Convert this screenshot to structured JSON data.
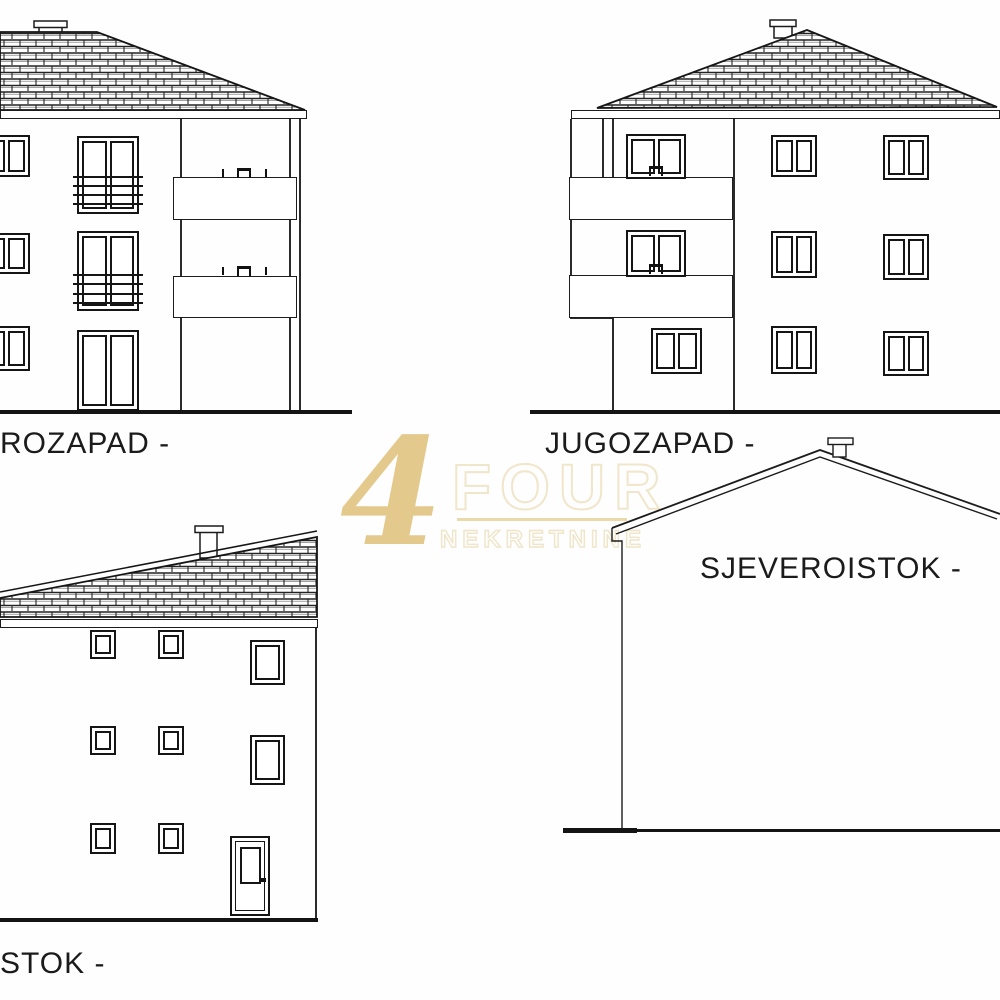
{
  "page": {
    "background": "#fefefe",
    "line_color": "#1c1c1c",
    "drawing_type": "building elevation drawings"
  },
  "watermark": {
    "symbol": "4",
    "word": "FOUR",
    "subtitle": "NEKRETNINE",
    "gold_color": "#debc72",
    "underline_color": "#e6d29a"
  },
  "elevations": [
    {
      "id": "northwest",
      "label": "ROZAPAD -"
    },
    {
      "id": "southwest",
      "label": "JUGOZAPAD -"
    },
    {
      "id": "northeast",
      "label": "SJEVEROISTOK -"
    },
    {
      "id": "southeast",
      "label": "STOK -"
    }
  ]
}
